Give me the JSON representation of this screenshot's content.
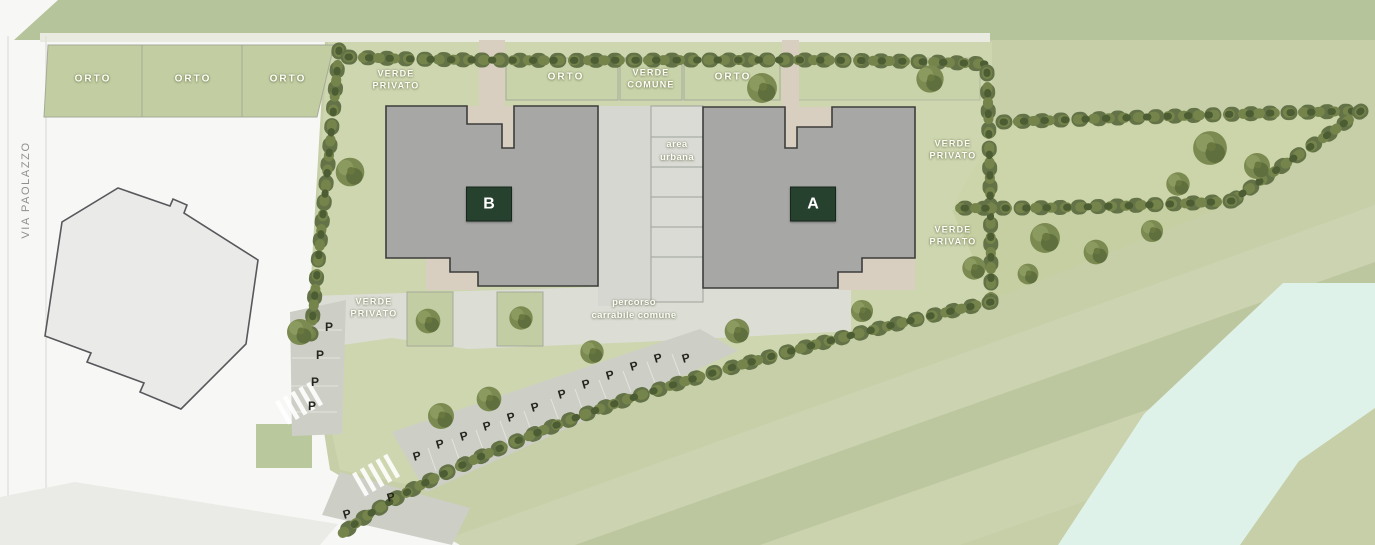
{
  "street": {
    "name": "VIA PAOLAZZO"
  },
  "garden_plots": {
    "plot_1": "ORTO",
    "plot_2": "ORTO",
    "plot_3": "ORTO",
    "plot_4": "ORTO",
    "plot_5": "ORTO"
  },
  "green_areas": {
    "verde_privato_top": "VERDE\nPRIVATO",
    "verde_comune": "VERDE\nCOMUNE",
    "verde_privato_east_upper": "VERDE\nPRIVATO",
    "verde_privato_east_lower": "VERDE\nPRIVATO",
    "verde_privato_south": "VERDE\nPRIVATO"
  },
  "zones": {
    "area_urbana": "area\nurbana",
    "driveway": "percorso\ncarrabile comune"
  },
  "buildings": {
    "a": "A",
    "b": "B"
  },
  "parking": {
    "marker": "P",
    "spaces_marked": 18
  },
  "colors": {
    "building_label_bg": "#27412f",
    "building_fill": "#a7a7a5",
    "grass": "#c7d0a9",
    "hedge": "#647347",
    "stream": "#dff2ea",
    "label_text": "#ffffff"
  }
}
